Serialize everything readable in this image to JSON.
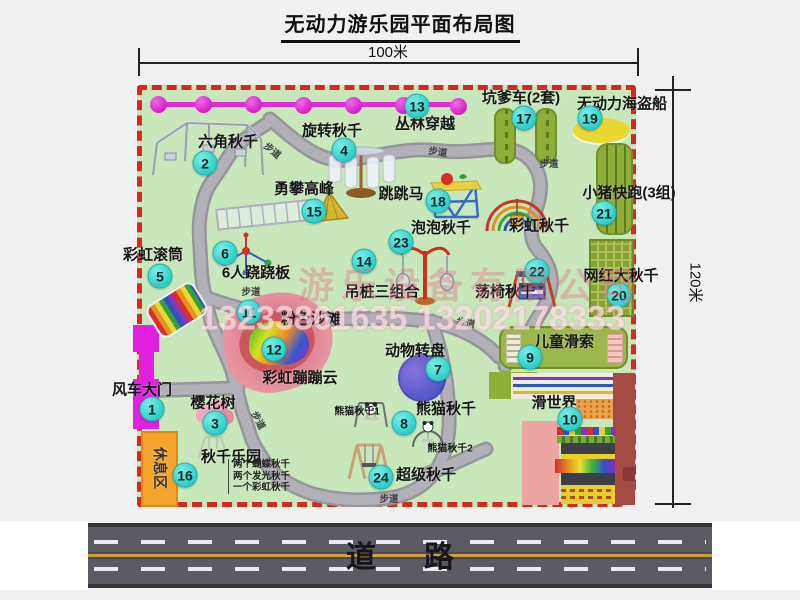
{
  "title": "无动力游乐园平面布局图",
  "dimensions": {
    "top": "100米",
    "right": "120米"
  },
  "road": {
    "label": "道路"
  },
  "watermark": {
    "company": "游乐设备有限公司",
    "phones": "13233861635 13202178333"
  },
  "map": {
    "walkways": {
      "label": "步道",
      "positions": [
        {
          "x": 273,
          "y": 150,
          "r": 40
        },
        {
          "x": 438,
          "y": 151,
          "r": 8
        },
        {
          "x": 549,
          "y": 163,
          "r": 0
        },
        {
          "x": 251,
          "y": 291,
          "r": 0
        },
        {
          "x": 259,
          "y": 420,
          "r": 62
        },
        {
          "x": 389,
          "y": 498,
          "r": 0
        },
        {
          "x": 466,
          "y": 322,
          "r": 12
        }
      ]
    },
    "items": [
      {
        "num": "1",
        "label": "风车大门",
        "lx": 142,
        "ly": 389,
        "cx": 152,
        "cy": 409
      },
      {
        "num": "2",
        "label": "六角秋千",
        "lx": 228,
        "ly": 141,
        "cx": 205,
        "cy": 163
      },
      {
        "num": "3",
        "label": "樱花树",
        "lx": 213,
        "ly": 402,
        "cx": 215,
        "cy": 423
      },
      {
        "num": "4",
        "label": "旋转秋千",
        "lx": 332,
        "ly": 130,
        "cx": 344,
        "cy": 150
      },
      {
        "num": "5",
        "label": "彩虹滚筒",
        "lx": 153,
        "ly": 254,
        "cx": 160,
        "cy": 276
      },
      {
        "num": "6",
        "label": "6人跷跷板",
        "lx": 256,
        "ly": 272,
        "cx": 225,
        "cy": 253
      },
      {
        "num": "7",
        "label": "动物转盘",
        "lx": 415,
        "ly": 350,
        "cx": 438,
        "cy": 369
      },
      {
        "num": "8",
        "label": "熊猫秋千",
        "lx": 446,
        "ly": 408,
        "cx": 404,
        "cy": 423
      },
      {
        "num": "9",
        "label": "儿童滑索",
        "lx": 564,
        "ly": 341,
        "cx": 530,
        "cy": 357
      },
      {
        "num": "10",
        "label": "滑世界",
        "lx": 554,
        "ly": 402,
        "cx": 570,
        "cy": 419
      },
      {
        "num": "11",
        "label": "粉色沙滩",
        "lx": 311,
        "ly": 318,
        "cx": 249,
        "cy": 312
      },
      {
        "num": "12",
        "label": "彩虹蹦蹦云",
        "lx": 300,
        "ly": 377,
        "cx": 274,
        "cy": 349
      },
      {
        "num": "13",
        "label": "丛林穿越",
        "lx": 425,
        "ly": 123,
        "cx": 417,
        "cy": 106
      },
      {
        "num": "14",
        "label": "吊桩三组合",
        "lx": 382,
        "ly": 291,
        "cx": 364,
        "cy": 261
      },
      {
        "num": "15",
        "label": "勇攀高峰",
        "lx": 304,
        "ly": 188,
        "cx": 314,
        "cy": 211
      },
      {
        "num": "16",
        "label": "秋千乐园",
        "lx": 231,
        "ly": 456,
        "cx": 185,
        "cy": 475
      },
      {
        "num": "17",
        "label": "坑爹车(2套)",
        "lx": 521,
        "ly": 97,
        "cx": 524,
        "cy": 118
      },
      {
        "num": "18",
        "label": "跳跳马",
        "lx": 401,
        "ly": 193,
        "cx": 438,
        "cy": 201
      },
      {
        "num": "19",
        "label": "无动力海盗船",
        "lx": 622,
        "ly": 103,
        "cx": 590,
        "cy": 118
      },
      {
        "num": "20",
        "label": "网红大秋千",
        "lx": 621,
        "ly": 275,
        "cx": 619,
        "cy": 295
      },
      {
        "num": "21",
        "label": "小猪快跑(3组)",
        "lx": 629,
        "ly": 192,
        "cx": 604,
        "cy": 213
      },
      {
        "num": "22",
        "label": "荡椅秋千",
        "lx": 505,
        "ly": 291,
        "cx": 537,
        "cy": 271
      },
      {
        "num": "23",
        "label": "泡泡秋千",
        "lx": 441,
        "ly": 227,
        "cx": 401,
        "cy": 242
      },
      {
        "num": "24",
        "label": "超级秋千",
        "lx": 426,
        "ly": 474,
        "cx": 381,
        "cy": 477
      }
    ],
    "extra_labels": [
      {
        "label": "彩虹秋千",
        "x": 539,
        "y": 225,
        "cls": ""
      },
      {
        "label": "熊猫秋千1",
        "x": 357,
        "y": 410,
        "cls": "small"
      },
      {
        "label": "熊猫秋千2",
        "x": 450,
        "y": 447,
        "cls": "small"
      },
      {
        "label": "休息区",
        "x": 160,
        "y": 468,
        "cls": "vertical"
      }
    ],
    "swing_park_notes": {
      "x": 228,
      "y": 459,
      "lines": [
        "两个蝴蝶秋千",
        "两个发光秋千",
        "一个彩虹秋千"
      ]
    }
  },
  "icons": [
    "windmill-gate-icon",
    "jungle-crossing-zipline-icon",
    "hexagon-swing-icon",
    "rotating-swing-icon",
    "climbing-peak-icon",
    "seesaw-icon",
    "rainbow-roller-icon",
    "pink-beach-icon",
    "rainbow-cloud-icon",
    "animal-turntable-icon",
    "panda-swing-1-icon",
    "panda-swing-2-icon",
    "super-swing-icon",
    "jumping-horse-icon",
    "rainbow-swing-arcs-icon",
    "bubble-swing-icon",
    "chair-swing-icon",
    "cherry-tree-icon",
    "park-swing-sketch-icon",
    "pit-car-track-icon",
    "pirate-ship-icon",
    "pig-run-track-icon",
    "big-swing-net-icon",
    "kids-zipline-icon",
    "slide-world-icon",
    "rest-area-block"
  ],
  "colors": {
    "map_green": "#c8e7bb",
    "border_red": "#d4291f",
    "badge_cyan": "#2ecfc9",
    "magenta": "#e02cd8",
    "path_gray": "#a3a2a8",
    "road_gray": "#5c5b64",
    "road_line_yellow": "#c9a23c",
    "equipment_olive": "#8fae38",
    "rest_orange": "#f5a42c",
    "beach_pink": "#e895a0",
    "turntable_purple": "#5a5fd0",
    "pirate_yellow": "#ead832",
    "watermark_pink": "#e87e8a"
  }
}
